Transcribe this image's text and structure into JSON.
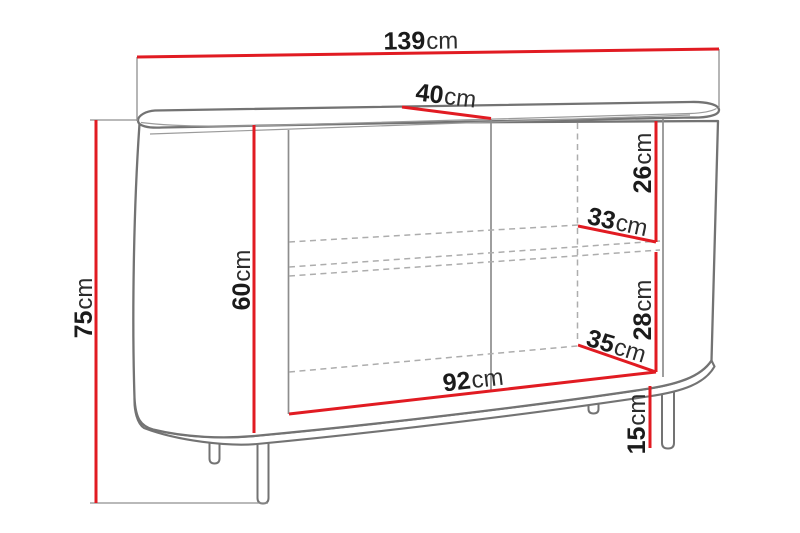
{
  "diagram": {
    "unit": "cm",
    "colors": {
      "dimension_line": "#e11b22",
      "outline": "#737373",
      "hidden_line": "#adadad",
      "extension_line": "#8f8f8f",
      "label_text": "#1b1b1b",
      "background": "#ffffff"
    },
    "dimensions": {
      "total_width": {
        "value": "139",
        "unit": "cm"
      },
      "top_depth": {
        "value": "40",
        "unit": "cm"
      },
      "right_upper_compartment_height": {
        "value": "26",
        "unit": "cm"
      },
      "right_shelf_width": {
        "value": "33",
        "unit": "cm"
      },
      "right_lower_compartment_height": {
        "value": "28",
        "unit": "cm"
      },
      "right_bottom_width": {
        "value": "35",
        "unit": "cm"
      },
      "interior_height": {
        "value": "60",
        "unit": "cm"
      },
      "total_height": {
        "value": "75",
        "unit": "cm"
      },
      "interior_width": {
        "value": "92",
        "unit": "cm"
      },
      "leg_height": {
        "value": "15",
        "unit": "cm"
      }
    }
  }
}
